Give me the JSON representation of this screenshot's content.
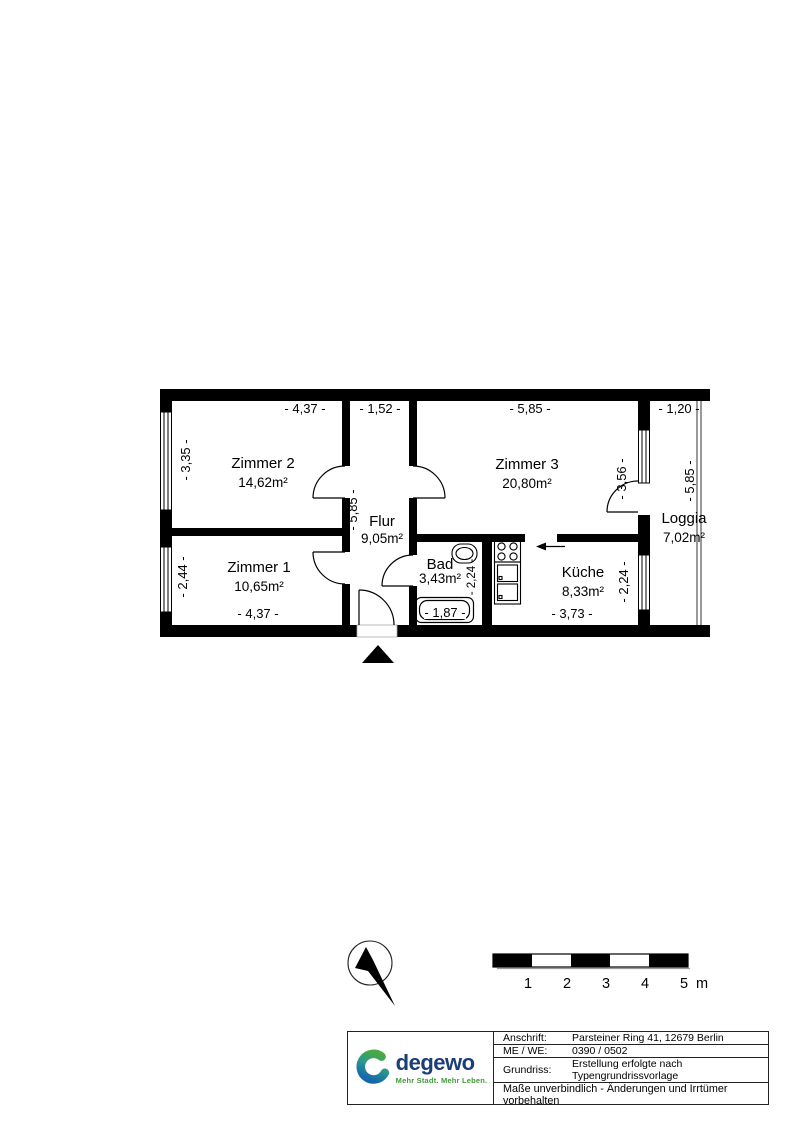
{
  "plan": {
    "wall_color": "#000000",
    "background_color": "#ffffff",
    "rooms": [
      {
        "name": "Zimmer 2",
        "area": "14,62m²"
      },
      {
        "name": "Zimmer 3",
        "area": "20,80m²"
      },
      {
        "name": "Zimmer 1",
        "area": "10,65m²"
      },
      {
        "name": "Flur",
        "area": "9,05m²"
      },
      {
        "name": "Bad",
        "area": "3,43m²"
      },
      {
        "name": "Küche",
        "area": "8,33m²"
      },
      {
        "name": "Loggia",
        "area": "7,02m²"
      }
    ],
    "dimensions": {
      "top_zimmer2": "- 4,37 -",
      "top_flur": "- 1,52 -",
      "top_zimmer3": "- 5,85 -",
      "top_loggia": "- 1,20 -",
      "left_zimmer2": "- 3,35 -",
      "left_zimmer1": "- 2,44 -",
      "flur_vertical": "- 5,85 -",
      "bad_vertical": "- 2,24 -",
      "zimmer3_loggia": "- 3,56 -",
      "kueche_vertical": "- 2,24 -",
      "loggia_vertical": "- 5,85 -",
      "bottom_zimmer1": "- 4,37 -",
      "bottom_bad": "- 1,87 -",
      "bottom_kueche": "- 3,73 -"
    },
    "icons": {
      "north_arrow": "compass-needle-in-circle",
      "entrance_marker": "solid-triangle-up",
      "kitchen_entry": "arrow-left",
      "bath_fixtures": [
        "washbasin",
        "bathtub"
      ],
      "kitchen_fixtures": [
        "cooktop-4-burners",
        "double-sink-unit"
      ]
    }
  },
  "scale_bar": {
    "labels": [
      "1",
      "2",
      "3",
      "4",
      "5"
    ],
    "unit": "m"
  },
  "title_block": {
    "logo": {
      "brand": "degewo",
      "tagline": "Mehr Stadt. Mehr Leben.",
      "brand_color": "#1c3e77",
      "tagline_color": "#3f9c35",
      "swirl_green": "#49a942",
      "swirl_blue": "#1666ad"
    },
    "rows": [
      {
        "label": "Anschrift:",
        "value": "Parsteiner Ring 41, 12679 Berlin"
      },
      {
        "label": "ME / WE:",
        "value": "0390 / 0502"
      },
      {
        "label": "Grundriss:",
        "value": "Erstellung erfolgte nach Typengrundrissvorlage"
      }
    ],
    "footer": "Maße unverbindlich - Änderungen und Irrtümer vorbehalten"
  }
}
